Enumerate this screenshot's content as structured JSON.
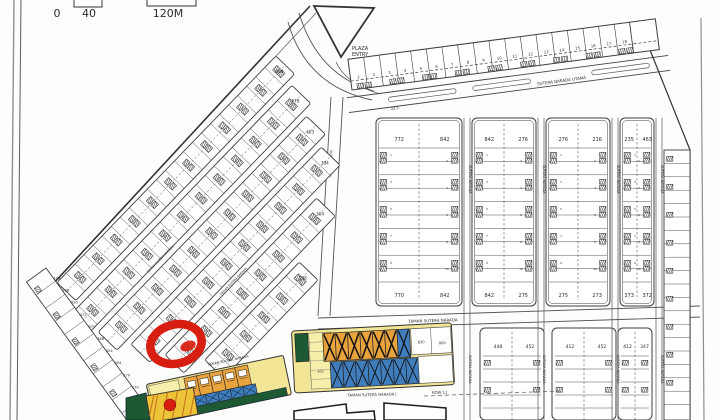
{
  "scale_bar": {
    "tick0": "0",
    "tick1": "40",
    "tick2": "120M"
  },
  "plaza_entry": {
    "line1": "PLAZA",
    "line2": "ENTRY",
    "line3": "STATEMENT"
  },
  "streets": {
    "main": "SUTERA NARADA UTAMA",
    "vertical": "SUTERA NARADA",
    "taman": "TAMAN SUTERA NARADA",
    "taman_row": "TAMAN SUTERA NARADA I",
    "row_label": "ROW 11",
    "width_dim": "22.5"
  },
  "shop_row": {
    "size_label": "15 x 20",
    "corner_lot": "577",
    "unit_numbers": [
      "1",
      "2",
      "3",
      "4",
      "5",
      "6",
      "7",
      "8",
      "9",
      "10",
      "11",
      "12",
      "13",
      "14",
      "15",
      "16",
      "17",
      "18"
    ]
  },
  "blocks_upper": [
    {
      "top_left": "772",
      "top_right": "842",
      "bottom_left": "770",
      "bottom_right": "842"
    },
    {
      "top_left": "842",
      "top_right": "276",
      "bottom_left": "842",
      "bottom_right": "275"
    },
    {
      "top_left": "276",
      "top_right": "216",
      "bottom_left": "275",
      "bottom_right": "273"
    },
    {
      "top_left": "235",
      "top_right": "463",
      "bottom_left": "373",
      "bottom_right": "372"
    }
  ],
  "blocks_lower": [
    {
      "left": "448",
      "right": "452"
    },
    {
      "left": "412",
      "right": "452"
    },
    {
      "left": "412",
      "right": "347"
    }
  ],
  "left_strip_corner_numbers": [
    "800",
    "678",
    "403",
    "394",
    "304",
    "198"
  ],
  "boundary_lot_numbers": [
    "199",
    "788",
    "520",
    "472",
    "375",
    "348",
    "324",
    "304",
    "279",
    "270",
    "254"
  ],
  "colored_panel": {
    "lot_a": "830",
    "lot_b": "800",
    "yellow_lot": "403"
  },
  "block_lot_numbers": [
    "1",
    "2",
    "3",
    "4",
    "5",
    "6",
    "7",
    "8",
    "9",
    "10",
    "11",
    "12"
  ],
  "colors": {
    "line": "#3d3d3d",
    "highlight_red": "#d81e10",
    "lot_orange": "#e8a33c",
    "lot_blue": "#3f7dbd",
    "lot_green": "#1d5a33",
    "panel_yellow": "#f2e596",
    "block_yellow": "#edc437",
    "light_yellow": "#f6eeab"
  }
}
